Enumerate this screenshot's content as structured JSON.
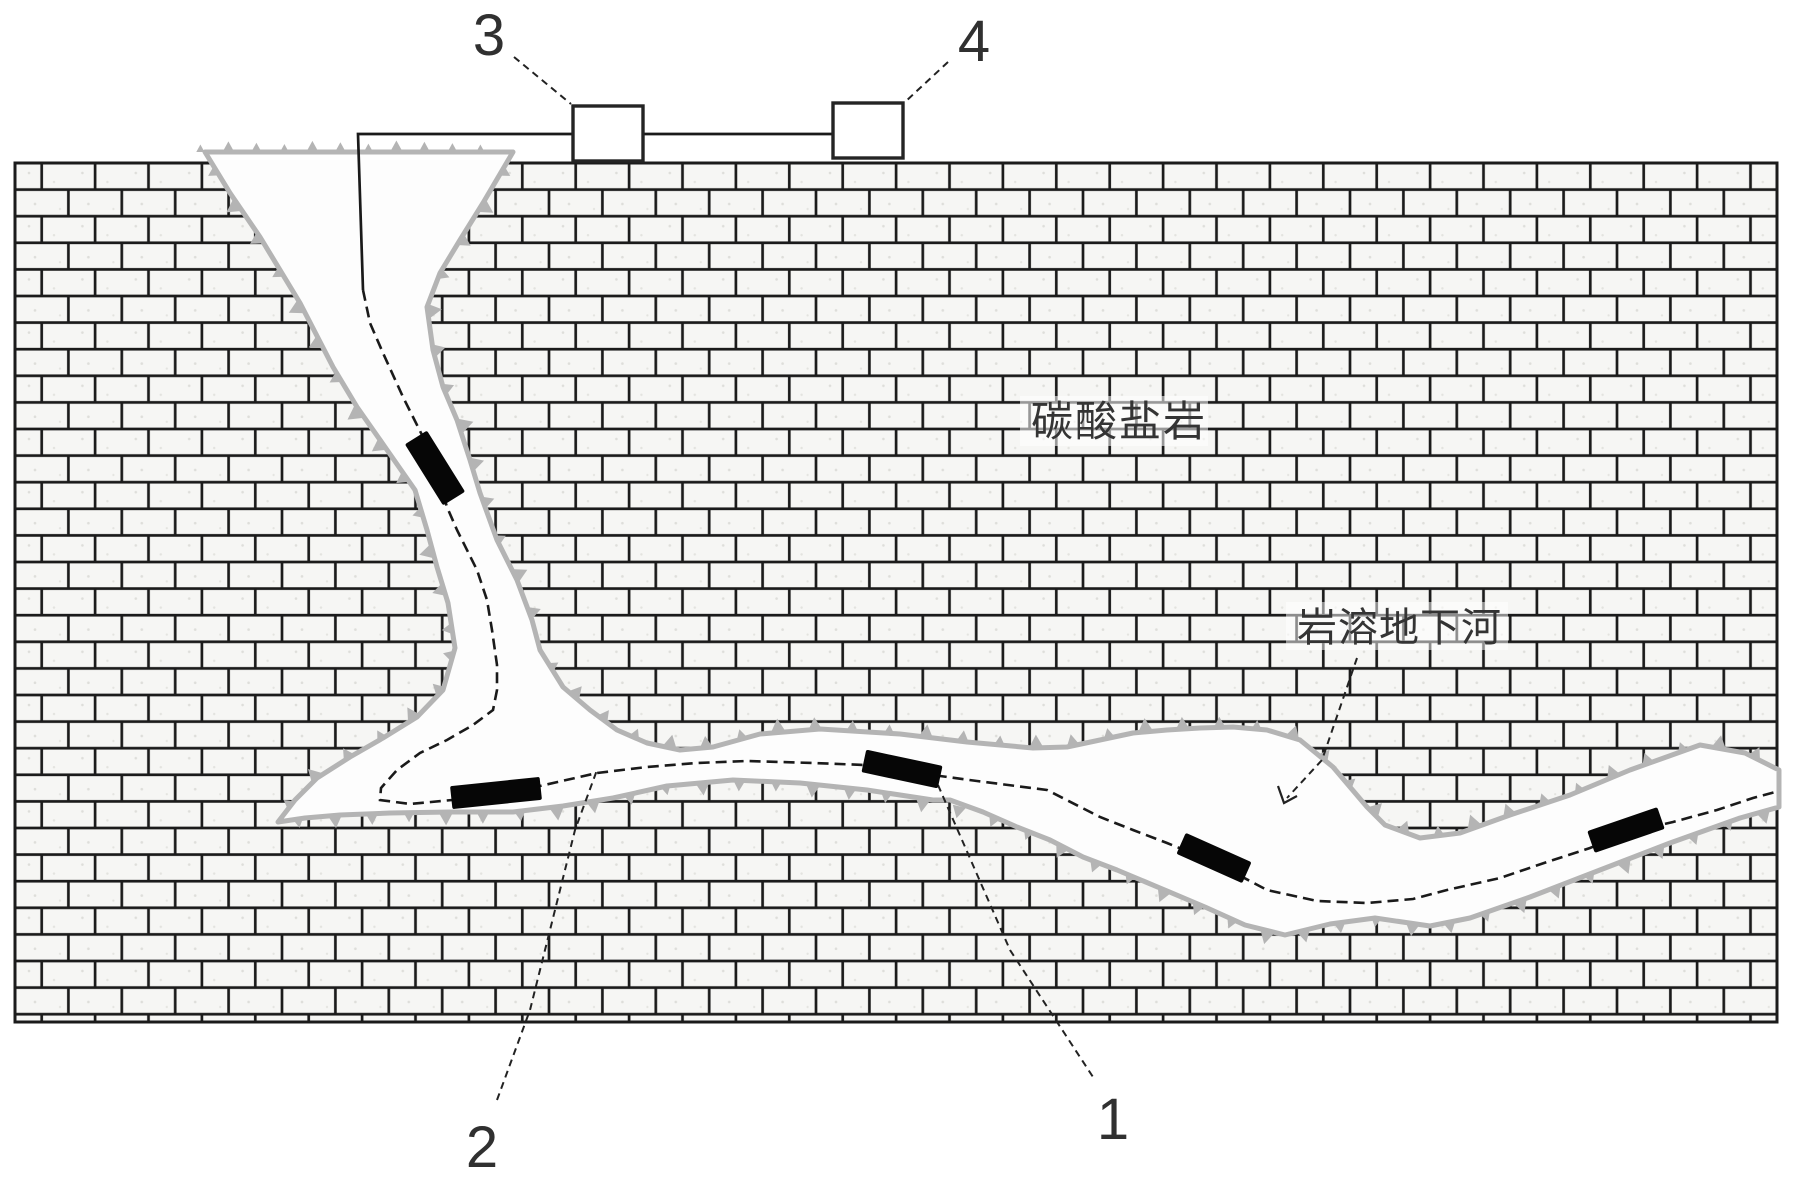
{
  "labels": {
    "rock_type": "碳酸盐岩",
    "underground_river": "岩溶地下河",
    "ref_1": "1",
    "ref_2": "2",
    "ref_3": "3",
    "ref_4": "4"
  },
  "colors": {
    "mortar": "#1b1b1b",
    "brick_fill": "#f6f6f4",
    "speckle": "#dededa",
    "channel_fill": "#fdfdfd",
    "boundary_gray": "#b4b4b4",
    "line_black": "#1a1a1a",
    "device_black": "#060606",
    "text_dark": "#303030",
    "halo_white": "rgba(255,255,255,0.55)"
  },
  "diagram": {
    "canvas": {
      "w": 1809,
      "h": 1179
    },
    "rock": {
      "x": 15,
      "y": 163,
      "w": 1762,
      "h": 859
    },
    "channel": {
      "outline": [
        [
          205,
          152
        ],
        [
          513,
          152
        ],
        [
          483,
          203
        ],
        [
          460,
          240
        ],
        [
          440,
          273
        ],
        [
          427,
          307
        ],
        [
          433,
          350
        ],
        [
          443,
          387
        ],
        [
          457,
          420
        ],
        [
          470,
          460
        ],
        [
          480,
          493
        ],
        [
          497,
          540
        ],
        [
          517,
          580
        ],
        [
          532,
          620
        ],
        [
          540,
          650
        ],
        [
          563,
          687
        ],
        [
          590,
          710
        ],
        [
          617,
          730
        ],
        [
          647,
          743
        ],
        [
          680,
          750
        ],
        [
          713,
          747
        ],
        [
          760,
          734
        ],
        [
          820,
          729
        ],
        [
          900,
          734
        ],
        [
          967,
          742
        ],
        [
          1033,
          748
        ],
        [
          1067,
          747
        ],
        [
          1100,
          740
        ],
        [
          1133,
          733
        ],
        [
          1167,
          730
        ],
        [
          1200,
          728
        ],
        [
          1233,
          727
        ],
        [
          1267,
          730
        ],
        [
          1300,
          740
        ],
        [
          1333,
          767
        ],
        [
          1350,
          787
        ],
        [
          1367,
          807
        ],
        [
          1385,
          825
        ],
        [
          1420,
          838
        ],
        [
          1460,
          833
        ],
        [
          1510,
          815
        ],
        [
          1570,
          795
        ],
        [
          1630,
          770
        ],
        [
          1700,
          745
        ],
        [
          1745,
          753
        ],
        [
          1779,
          770
        ],
        [
          1779,
          807
        ],
        [
          1740,
          818
        ],
        [
          1670,
          843
        ],
        [
          1600,
          870
        ],
        [
          1530,
          897
        ],
        [
          1470,
          918
        ],
        [
          1430,
          926
        ],
        [
          1375,
          918
        ],
        [
          1330,
          924
        ],
        [
          1285,
          935
        ],
        [
          1245,
          925
        ],
        [
          1205,
          907
        ],
        [
          1160,
          888
        ],
        [
          1117,
          870
        ],
        [
          1083,
          857
        ],
        [
          1050,
          840
        ],
        [
          1017,
          827
        ],
        [
          983,
          812
        ],
        [
          950,
          800
        ],
        [
          933,
          800
        ],
        [
          867,
          790
        ],
        [
          800,
          783
        ],
        [
          733,
          780
        ],
        [
          667,
          786
        ],
        [
          613,
          798
        ],
        [
          563,
          806
        ],
        [
          513,
          812
        ],
        [
          450,
          812
        ],
        [
          390,
          813
        ],
        [
          340,
          815
        ],
        [
          305,
          818
        ],
        [
          278,
          822
        ],
        [
          295,
          800
        ],
        [
          317,
          778
        ],
        [
          350,
          757
        ],
        [
          383,
          738
        ],
        [
          417,
          717
        ],
        [
          443,
          690
        ],
        [
          455,
          648
        ],
        [
          448,
          603
        ],
        [
          437,
          567
        ],
        [
          427,
          530
        ],
        [
          415,
          490
        ],
        [
          385,
          447
        ],
        [
          357,
          407
        ],
        [
          333,
          367
        ],
        [
          300,
          303
        ],
        [
          260,
          237
        ],
        [
          230,
          193
        ]
      ]
    },
    "hachures": [
      {
        "name": "ground-surface",
        "pts": [
          [
            185,
            152
          ],
          [
            500,
            152
          ]
        ],
        "side": -1,
        "spacing": 28,
        "size": 10
      },
      {
        "name": "sinkhole-left-wall",
        "pts": [
          [
            205,
            152
          ],
          [
            230,
            193
          ],
          [
            260,
            237
          ],
          [
            300,
            303
          ],
          [
            333,
            367
          ],
          [
            357,
            407
          ],
          [
            385,
            447
          ],
          [
            415,
            490
          ],
          [
            427,
            530
          ],
          [
            437,
            567
          ],
          [
            448,
            603
          ],
          [
            455,
            648
          ]
        ],
        "side": 1,
        "spacing": 40,
        "size": 13
      },
      {
        "name": "sinkhole-right-wall",
        "pts": [
          [
            513,
            152
          ],
          [
            483,
            203
          ],
          [
            460,
            240
          ],
          [
            440,
            273
          ],
          [
            427,
            307
          ],
          [
            433,
            350
          ],
          [
            443,
            387
          ],
          [
            457,
            420
          ],
          [
            470,
            460
          ],
          [
            480,
            493
          ],
          [
            497,
            540
          ],
          [
            517,
            580
          ],
          [
            532,
            620
          ],
          [
            540,
            650
          ]
        ],
        "side": -1,
        "spacing": 40,
        "size": 13
      },
      {
        "name": "tail-upper-wall",
        "pts": [
          [
            278,
            822
          ],
          [
            295,
            800
          ],
          [
            317,
            778
          ],
          [
            350,
            757
          ],
          [
            383,
            738
          ],
          [
            417,
            717
          ],
          [
            443,
            690
          ],
          [
            455,
            648
          ]
        ],
        "side": -1,
        "spacing": 38,
        "size": 12
      },
      {
        "name": "gallery-roof",
        "pts": [
          [
            540,
            650
          ],
          [
            563,
            687
          ],
          [
            590,
            710
          ],
          [
            617,
            730
          ],
          [
            647,
            743
          ],
          [
            680,
            750
          ],
          [
            713,
            747
          ],
          [
            760,
            734
          ],
          [
            820,
            729
          ],
          [
            900,
            734
          ],
          [
            967,
            742
          ],
          [
            1033,
            748
          ],
          [
            1067,
            747
          ],
          [
            1100,
            740
          ],
          [
            1133,
            733
          ],
          [
            1167,
            730
          ],
          [
            1200,
            728
          ],
          [
            1233,
            727
          ],
          [
            1267,
            730
          ],
          [
            1300,
            740
          ],
          [
            1333,
            767
          ],
          [
            1350,
            787
          ],
          [
            1367,
            807
          ],
          [
            1385,
            825
          ],
          [
            1420,
            838
          ],
          [
            1460,
            833
          ],
          [
            1510,
            815
          ],
          [
            1570,
            795
          ],
          [
            1630,
            770
          ],
          [
            1700,
            745
          ],
          [
            1745,
            753
          ],
          [
            1779,
            770
          ]
        ],
        "side": -1,
        "spacing": 37,
        "size": 12
      },
      {
        "name": "gallery-floor",
        "pts": [
          [
            278,
            822
          ],
          [
            305,
            818
          ],
          [
            340,
            815
          ],
          [
            390,
            813
          ],
          [
            450,
            812
          ],
          [
            513,
            812
          ],
          [
            563,
            806
          ],
          [
            613,
            798
          ],
          [
            667,
            786
          ],
          [
            733,
            780
          ],
          [
            800,
            783
          ],
          [
            867,
            790
          ],
          [
            933,
            800
          ],
          [
            983,
            812
          ],
          [
            1017,
            827
          ],
          [
            1050,
            840
          ],
          [
            1083,
            857
          ],
          [
            1117,
            870
          ],
          [
            1160,
            888
          ],
          [
            1205,
            907
          ],
          [
            1245,
            925
          ],
          [
            1285,
            935
          ],
          [
            1330,
            924
          ],
          [
            1375,
            918
          ],
          [
            1430,
            926
          ],
          [
            1470,
            918
          ],
          [
            1530,
            897
          ],
          [
            1600,
            870
          ],
          [
            1670,
            843
          ],
          [
            1740,
            818
          ],
          [
            1779,
            807
          ]
        ],
        "side": 1,
        "spacing": 37,
        "size": 12
      }
    ],
    "wires": [
      {
        "name": "wire-box3-to-borehole",
        "pts": [
          [
            573,
            134
          ],
          [
            358,
            134
          ],
          [
            363,
            290
          ]
        ]
      },
      {
        "name": "wire-box3-to-box4",
        "pts": [
          [
            643,
            134
          ],
          [
            833,
            134
          ]
        ]
      }
    ],
    "cable": {
      "pts": [
        [
          363,
          290
        ],
        [
          370,
          323
        ],
        [
          383,
          353
        ],
        [
          403,
          397
        ],
        [
          423,
          437
        ],
        [
          435,
          468
        ],
        [
          447,
          507
        ],
        [
          457,
          530
        ],
        [
          477,
          570
        ],
        [
          487,
          600
        ],
        [
          492,
          630
        ],
        [
          497,
          665
        ],
        [
          497,
          690
        ],
        [
          493,
          710
        ],
        [
          473,
          725
        ],
        [
          447,
          740
        ],
        [
          420,
          753
        ],
        [
          397,
          770
        ],
        [
          381,
          788
        ],
        [
          380,
          800
        ],
        [
          410,
          804
        ],
        [
          452,
          800
        ],
        [
          496,
          793
        ],
        [
          540,
          786
        ],
        [
          597,
          773
        ],
        [
          647,
          767
        ],
        [
          697,
          763
        ],
        [
          747,
          761
        ],
        [
          813,
          763
        ],
        [
          865,
          765
        ],
        [
          902,
          770
        ],
        [
          940,
          776
        ],
        [
          977,
          781
        ],
        [
          1047,
          790
        ],
        [
          1100,
          817
        ],
        [
          1133,
          830
        ],
        [
          1167,
          843
        ],
        [
          1214,
          862
        ],
        [
          1267,
          890
        ],
        [
          1317,
          901
        ],
        [
          1367,
          903
        ],
        [
          1413,
          899
        ],
        [
          1447,
          890
        ],
        [
          1500,
          878
        ],
        [
          1547,
          862
        ],
        [
          1590,
          848
        ],
        [
          1626,
          833
        ],
        [
          1673,
          822
        ],
        [
          1717,
          810
        ],
        [
          1753,
          798
        ],
        [
          1779,
          791
        ]
      ],
      "dash": "11 6"
    },
    "devices": [
      {
        "cx": 435,
        "cy": 468,
        "len": 72,
        "w": 26,
        "angle": 58
      },
      {
        "cx": 496,
        "cy": 793,
        "len": 90,
        "w": 23,
        "angle": -6
      },
      {
        "cx": 902,
        "cy": 769,
        "len": 78,
        "w": 23,
        "angle": 12
      },
      {
        "cx": 1214,
        "cy": 858,
        "len": 72,
        "w": 23,
        "angle": 24
      },
      {
        "cx": 1626,
        "cy": 830,
        "len": 74,
        "w": 23,
        "angle": -19
      }
    ],
    "boxes": [
      {
        "name": "instrument-box-3",
        "x": 573,
        "y": 106,
        "w": 70,
        "h": 55
      },
      {
        "name": "instrument-box-4",
        "x": 833,
        "y": 103,
        "w": 70,
        "h": 55
      }
    ],
    "leaders": [
      {
        "name": "leader-ref-3",
        "pts": [
          [
            514,
            57
          ],
          [
            571,
            104
          ]
        ]
      },
      {
        "name": "leader-ref-4",
        "pts": [
          [
            948,
            62
          ],
          [
            905,
            102
          ]
        ]
      },
      {
        "name": "leader-ref-1",
        "pts": [
          [
            938,
            785
          ],
          [
            1010,
            950
          ],
          [
            1093,
            1077
          ]
        ]
      },
      {
        "name": "leader-ref-2",
        "pts": [
          [
            497,
            1100
          ],
          [
            530,
            1010
          ],
          [
            575,
            830
          ],
          [
            597,
            770
          ]
        ]
      },
      {
        "name": "leader-river-label",
        "pts": [
          [
            1357,
            658
          ],
          [
            1322,
            760
          ],
          [
            1287,
            798
          ]
        ]
      }
    ],
    "river_arrow": [
      [
        1278,
        786
      ],
      [
        1284,
        803
      ],
      [
        1297,
        796
      ]
    ]
  }
}
